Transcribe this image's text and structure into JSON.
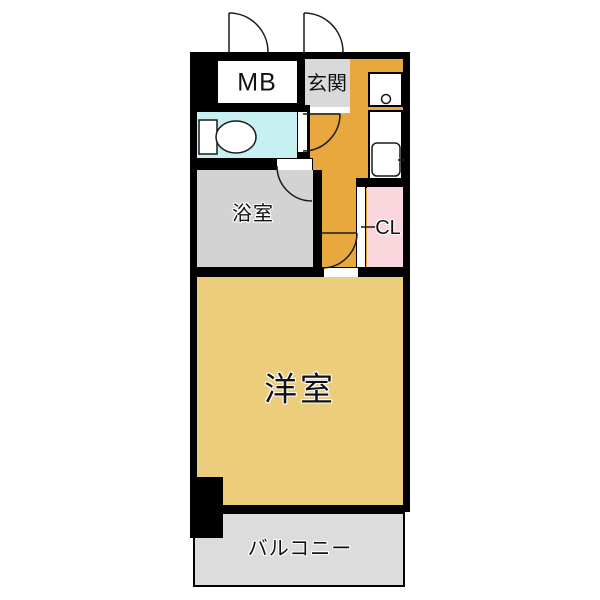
{
  "document": {
    "type": "floor-plan",
    "language": "ja"
  },
  "labels": {
    "mb": "MB",
    "entrance": "玄関",
    "bathroom": "浴室",
    "closet": "CL",
    "western_room": "洋室",
    "balcony": "バルコニー"
  },
  "icons": {
    "toilet": "toilet-icon",
    "kitchen_sink": "sink-icon",
    "stove_burner": "burner-icon",
    "door_swings": "door-swing-arc-icon"
  },
  "colors": {
    "wall": "#000000",
    "hallway_kitchen_floor": "#e8a83e",
    "western_room_floor": "#ebcd7b",
    "toilet_floor": "#c6f0f2",
    "entrance_floor": "#d9d9d9",
    "bathroom_floor": "#d3d3d3",
    "closet_floor": "#fad7dc",
    "balcony_floor": "#dcdcdc",
    "background": "#ffffff"
  }
}
